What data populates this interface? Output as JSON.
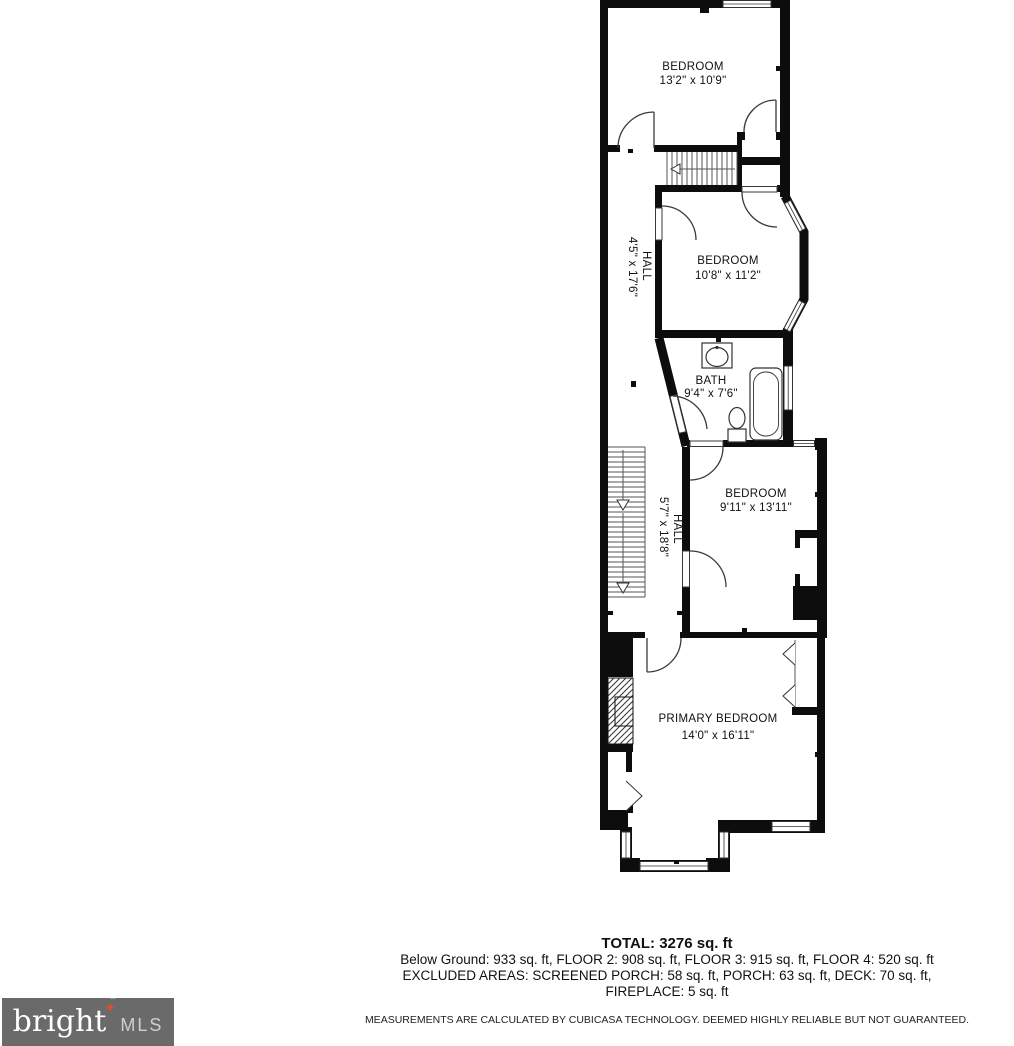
{
  "plan": {
    "rooms": [
      {
        "id": "bedroom-1",
        "name": "BEDROOM",
        "dims": "13'2\" x 10'9\""
      },
      {
        "id": "hall-upper",
        "name": "HALL",
        "dims": "4'5\" x 17'6\""
      },
      {
        "id": "bedroom-2",
        "name": "BEDROOM",
        "dims": "10'8\" x 11'2\""
      },
      {
        "id": "bath",
        "name": "BATH",
        "dims": "9'4\" x 7'6\""
      },
      {
        "id": "bedroom-3",
        "name": "BEDROOM",
        "dims": "9'11\" x 13'11\""
      },
      {
        "id": "hall-lower",
        "name": "HALL",
        "dims": "5'7\" x 18'8\""
      },
      {
        "id": "primary-bedroom",
        "name": "PRIMARY BEDROOM",
        "dims": "14'0\" x 16'11\""
      }
    ]
  },
  "summary": {
    "total": "TOTAL: 3276 sq. ft",
    "line2": "Below Ground: 933 sq. ft, FLOOR 2: 908 sq. ft, FLOOR 3: 915 sq. ft, FLOOR 4: 520 sq. ft",
    "line3": "EXCLUDED AREAS: SCREENED PORCH: 58 sq. ft, PORCH: 63 sq. ft, DECK: 70 sq. ft,",
    "line4": "FIREPLACE: 5 sq. ft",
    "disclaimer": "MEASUREMENTS ARE CALCULATED BY CUBICASA TECHNOLOGY. DEEMED HIGHLY RELIABLE BUT NOT GUARANTEED."
  },
  "logo": {
    "brand": "bright",
    "suffix": "MLS",
    "tm": "™",
    "star": "✦"
  },
  "colors": {
    "wall": "#0d0d0d",
    "logo_background": "#6a6a6a",
    "logo_star": "#d9512c",
    "logo_mls_text": "#cfcfcf"
  }
}
